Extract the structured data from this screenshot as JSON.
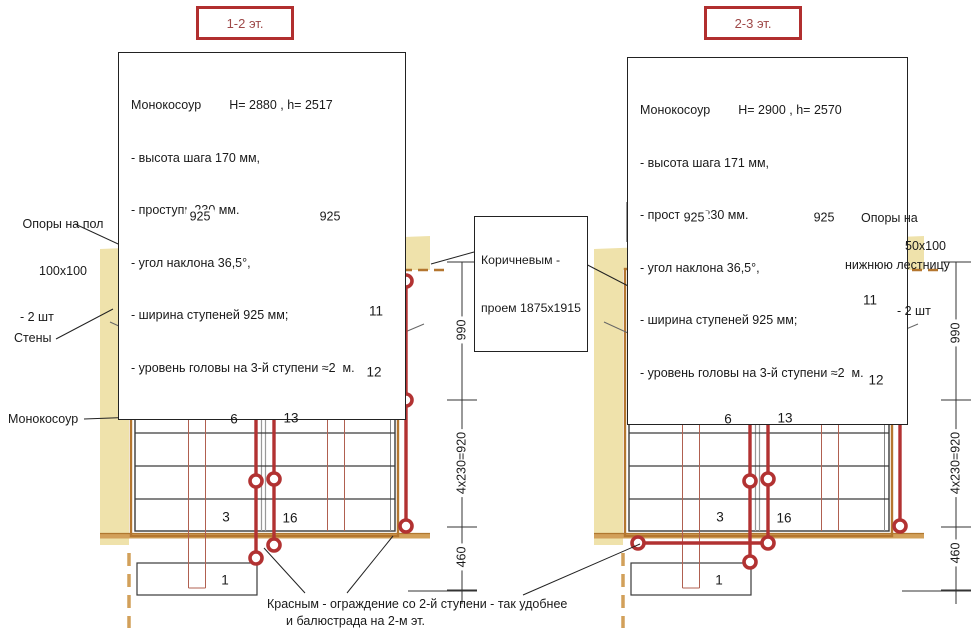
{
  "plans": {
    "left": {
      "floor_tag": "1-2 эт.",
      "spec": {
        "name": "Монокосоур",
        "values": "H= 2880 , h= 2517",
        "items": [
          "- высота шага 170 мм,",
          "- проступь 230 мм.",
          "- угол наклона 36,5°,",
          "- ширина ступеней 925 мм;",
          "- уровень головы на 3-й ступени ≈2  м."
        ]
      },
      "dims": {
        "w1": "925",
        "w2": "925",
        "h1": "990",
        "h2": "4x230=920",
        "h3": "460"
      },
      "steps": {
        "n1": "1",
        "n3": "3",
        "n6": "6",
        "n11": "11",
        "n12": "12",
        "n13": "13",
        "n16": "16"
      }
    },
    "right": {
      "floor_tag": "2-3 эт.",
      "spec": {
        "name": "Монокосоур",
        "values": "H= 2900 , h= 2570",
        "items": [
          "- высота шага 171 мм,",
          "- проступь 230 мм.",
          "- угол наклона 36,5°,",
          "- ширина ступеней 925 мм;",
          "- уровень головы на 3-й ступени ≈2  м."
        ]
      },
      "dims": {
        "w1": "925",
        "w2": "925",
        "h1": "990",
        "h2": "4x230=920",
        "h3": "460"
      },
      "steps": {
        "n1": "1",
        "n3": "3",
        "n6": "6",
        "n11": "11",
        "n12": "12",
        "n13": "13",
        "n16": "16"
      }
    }
  },
  "annotations": {
    "supports_floor": [
      "Опоры на пол",
      "100x100",
      "- 2 шт"
    ],
    "walls": "Стены",
    "stringer": "Монокосоур",
    "opening": [
      "Коричневым -",
      "проем 1875x1915"
    ],
    "supports_lower": [
      "Опоры на",
      "нижнюю лестницу",
      "- 2 шт"
    ],
    "support_size": "50x100",
    "note": [
      "Красным - ограждение со 2-й ступени - так удобнее",
      "и балюстрада на 2-м эт."
    ]
  },
  "colors": {
    "wall": "#efe2ab",
    "opening_brown": "#b4762f",
    "floor_tan": "#d2a05a",
    "railing_red": "#b23232",
    "support_pink": "#f6afc7",
    "title_red": "#b12f2f"
  }
}
